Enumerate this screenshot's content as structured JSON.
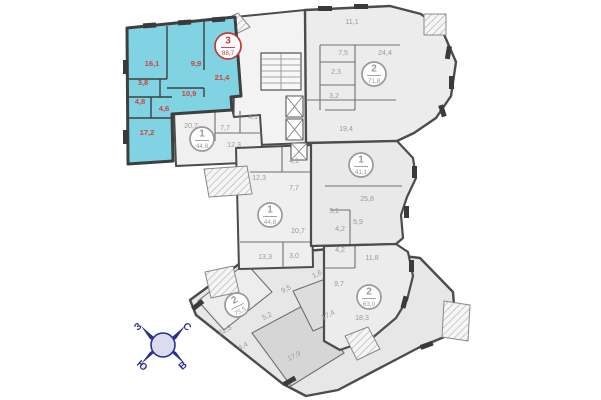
{
  "title": "floor-plan",
  "palette": {
    "highlight_fill": "#7fd3e2",
    "highlight_wall": "#3f3f3f",
    "red_text": "#cf4343",
    "badge_red": "#c63838",
    "gray_text": "#9a9a9a",
    "wall": "#4c4c4c",
    "apartment_fill": "#ececec",
    "navy": "#2b2f8e"
  },
  "apartments": [
    {
      "rooms": "3",
      "area": "88,7",
      "x": 228,
      "y": 46,
      "highlight": true,
      "rot": 0
    },
    {
      "rooms": "2",
      "area": "71,8",
      "x": 374,
      "y": 74,
      "highlight": false,
      "rot": 0
    },
    {
      "rooms": "1",
      "area": "44,8",
      "x": 202,
      "y": 139,
      "highlight": false,
      "rot": 0
    },
    {
      "rooms": "1",
      "area": "41,1",
      "x": 361,
      "y": 165,
      "highlight": false,
      "rot": 0
    },
    {
      "rooms": "1",
      "area": "44,8",
      "x": 270,
      "y": 215,
      "highlight": false,
      "rot": 0
    },
    {
      "rooms": "2",
      "area": "75,5",
      "x": 237,
      "y": 305,
      "highlight": false,
      "rot": -27
    },
    {
      "rooms": "2",
      "area": "63,0",
      "x": 369,
      "y": 297,
      "highlight": false,
      "rot": 0
    }
  ],
  "room_labels": [
    {
      "t": "16,1",
      "x": 152,
      "y": 66,
      "c": "red",
      "rot": 0
    },
    {
      "t": "9,9",
      "x": 196,
      "y": 66,
      "c": "red",
      "rot": 0
    },
    {
      "t": "21,4",
      "x": 222,
      "y": 80,
      "c": "red",
      "rot": 0
    },
    {
      "t": "3,8",
      "x": 143,
      "y": 85,
      "c": "red",
      "rot": 0
    },
    {
      "t": "10,9",
      "x": 189,
      "y": 96,
      "c": "red",
      "rot": 0
    },
    {
      "t": "4,8",
      "x": 140,
      "y": 104,
      "c": "red",
      "rot": 0
    },
    {
      "t": "4,6",
      "x": 164,
      "y": 111,
      "c": "red",
      "rot": 0
    },
    {
      "t": "17,2",
      "x": 147,
      "y": 135,
      "c": "red",
      "rot": 0
    },
    {
      "t": "11,1",
      "x": 352,
      "y": 24,
      "c": "gray",
      "rot": 0
    },
    {
      "t": "7,5",
      "x": 343,
      "y": 55,
      "c": "gray",
      "rot": 0
    },
    {
      "t": "24,4",
      "x": 385,
      "y": 55,
      "c": "gray",
      "rot": 0
    },
    {
      "t": "2,3",
      "x": 336,
      "y": 74,
      "c": "gray",
      "rot": 0
    },
    {
      "t": "3,2",
      "x": 334,
      "y": 98,
      "c": "gray",
      "rot": 0
    },
    {
      "t": "19,4",
      "x": 346,
      "y": 131,
      "c": "gray",
      "rot": 0
    },
    {
      "t": "20,7",
      "x": 191,
      "y": 128,
      "c": "gray",
      "rot": 0
    },
    {
      "t": "7,7",
      "x": 225,
      "y": 130,
      "c": "gray",
      "rot": 0
    },
    {
      "t": "4,1",
      "x": 253,
      "y": 119,
      "c": "gray",
      "rot": 0
    },
    {
      "t": "12,3",
      "x": 234,
      "y": 147,
      "c": "gray",
      "rot": 0
    },
    {
      "t": "12,3",
      "x": 259,
      "y": 180,
      "c": "gray",
      "rot": 0
    },
    {
      "t": "4,1",
      "x": 294,
      "y": 163,
      "c": "gray",
      "rot": 0
    },
    {
      "t": "7,7",
      "x": 294,
      "y": 190,
      "c": "gray",
      "rot": 0
    },
    {
      "t": "20,7",
      "x": 298,
      "y": 233,
      "c": "gray",
      "rot": 0
    },
    {
      "t": "25,8",
      "x": 367,
      "y": 201,
      "c": "gray",
      "rot": 0
    },
    {
      "t": "3,1",
      "x": 334,
      "y": 213,
      "c": "gray",
      "rot": 0
    },
    {
      "t": "5,9",
      "x": 358,
      "y": 224,
      "c": "gray",
      "rot": 0
    },
    {
      "t": "4,2",
      "x": 340,
      "y": 231,
      "c": "gray",
      "rot": 0
    },
    {
      "t": "4,2",
      "x": 340,
      "y": 252,
      "c": "gray",
      "rot": 0
    },
    {
      "t": "11,8",
      "x": 372,
      "y": 260,
      "c": "gray",
      "rot": 0
    },
    {
      "t": "13,3",
      "x": 265,
      "y": 259,
      "c": "gray",
      "rot": 0
    },
    {
      "t": "3,0",
      "x": 294,
      "y": 258,
      "c": "gray",
      "rot": 0
    },
    {
      "t": "9,7",
      "x": 339,
      "y": 286,
      "c": "gray",
      "rot": 0
    },
    {
      "t": "18,3",
      "x": 362,
      "y": 320,
      "c": "gray",
      "rot": 0
    },
    {
      "t": "9,5",
      "x": 287,
      "y": 291,
      "c": "gray",
      "rot": -27
    },
    {
      "t": "1,6",
      "x": 318,
      "y": 276,
      "c": "gray",
      "rot": -27
    },
    {
      "t": "17,4",
      "x": 329,
      "y": 317,
      "c": "gray",
      "rot": -27
    },
    {
      "t": "5,2",
      "x": 268,
      "y": 318,
      "c": "gray",
      "rot": -27
    },
    {
      "t": "22,5",
      "x": 226,
      "y": 332,
      "c": "gray",
      "rot": -27
    },
    {
      "t": "4,4",
      "x": 244,
      "y": 348,
      "c": "gray",
      "rot": -27
    },
    {
      "t": "17,9",
      "x": 295,
      "y": 358,
      "c": "gray",
      "rot": -27
    }
  ],
  "compass": {
    "x": 163,
    "y": 345,
    "points": [
      {
        "label": "С",
        "dx": 22,
        "dy": -16,
        "rot": 42
      },
      {
        "label": "З",
        "dx": -23,
        "dy": -16,
        "rot": -42
      },
      {
        "label": "Ю",
        "dx": -23,
        "dy": 23,
        "rot": 42
      },
      {
        "label": "В",
        "dx": 22,
        "dy": 23,
        "rot": -42
      }
    ]
  }
}
